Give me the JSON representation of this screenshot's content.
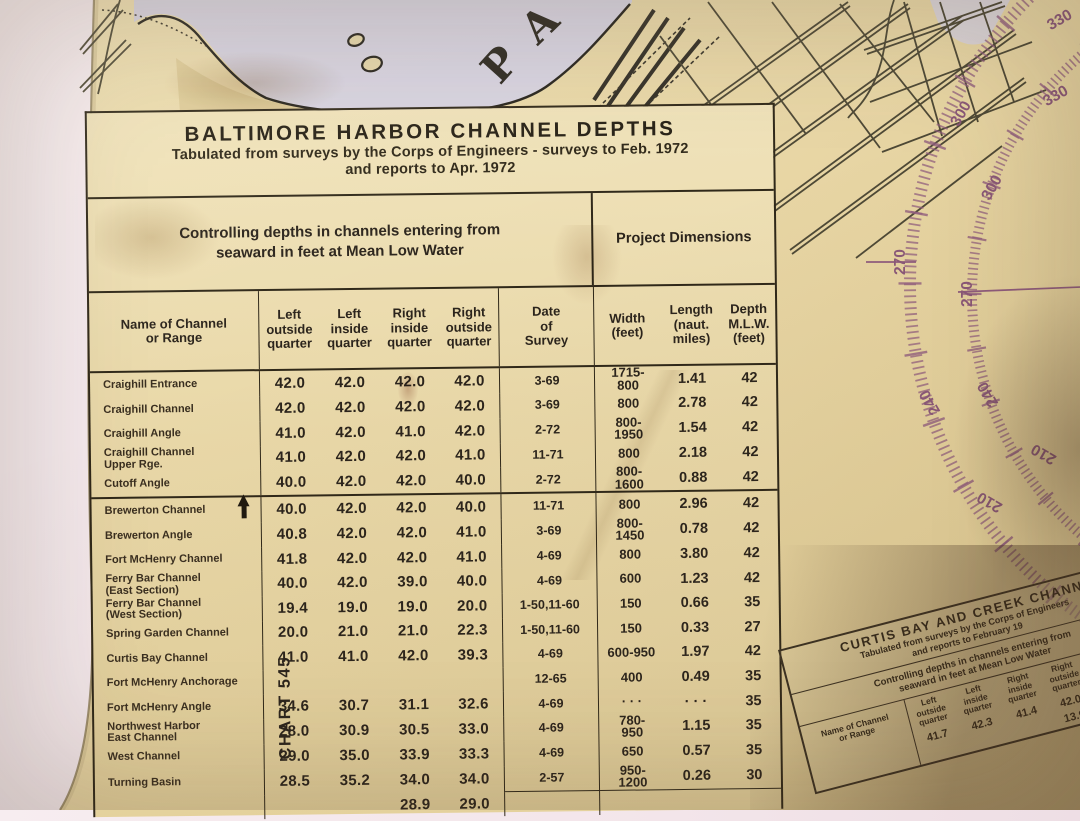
{
  "main_table": {
    "title": "BALTIMORE HARBOR CHANNEL DEPTHS",
    "subtitle1": "Tabulated from surveys by the Corps of Engineers - surveys to Feb. 1972",
    "subtitle2": "and reports to Apr. 1972",
    "group_header_left": "Controlling depths in channels entering from\nseaward in feet at Mean Low Water",
    "group_header_right": "Project Dimensions",
    "columns": {
      "name": "Name of Channel\nor Range",
      "q1": "Left\noutside\nquarter",
      "q2": "Left\ninside\nquarter",
      "q3": "Right\ninside\nquarter",
      "q4": "Right\noutside\nquarter",
      "date": "Date\nof\nSurvey",
      "width": "Width\n(feet)",
      "length": "Length\n(naut.\nmiles)",
      "depth": "Depth\nM.L.W.\n(feet)"
    },
    "chart_label": "CHART 545",
    "rows": [
      {
        "n": "Craighill Entrance",
        "q1": "42.0",
        "q2": "42.0",
        "q3": "42.0",
        "q4": "42.0",
        "date": "3-69",
        "w": "1715-\n800",
        "len": "1.41",
        "dep": "42"
      },
      {
        "n": "Craighill Channel",
        "q1": "42.0",
        "q2": "42.0",
        "q3": "42.0",
        "q4": "42.0",
        "date": "3-69",
        "w": "800",
        "len": "2.78",
        "dep": "42"
      },
      {
        "n": "Craighill Angle",
        "q1": "41.0",
        "q2": "42.0",
        "q3": "41.0",
        "q4": "42.0",
        "date": "2-72",
        "w": "800-\n1950",
        "len": "1.54",
        "dep": "42"
      },
      {
        "n": "Craighill Channel\nUpper Rge.",
        "q1": "41.0",
        "q2": "42.0",
        "q3": "42.0",
        "q4": "41.0",
        "date": "11-71",
        "w": "800",
        "len": "2.18",
        "dep": "42"
      },
      {
        "n": "Cutoff Angle",
        "q1": "40.0",
        "q2": "42.0",
        "q3": "42.0",
        "q4": "40.0",
        "date": "2-72",
        "w": "800-\n1600",
        "len": "0.88",
        "dep": "42"
      },
      {
        "n": "Brewerton Channel",
        "arrow": true,
        "q1": "40.0",
        "q2": "42.0",
        "q3": "42.0",
        "q4": "40.0",
        "date": "11-71",
        "w": "800",
        "len": "2.96",
        "dep": "42"
      },
      {
        "n": "Brewerton Angle",
        "q1": "40.8",
        "q2": "42.0",
        "q3": "42.0",
        "q4": "41.0",
        "date": "3-69",
        "w": "800-\n1450",
        "len": "0.78",
        "dep": "42"
      },
      {
        "n": "Fort McHenry Channel",
        "q1": "41.8",
        "q2": "42.0",
        "q3": "42.0",
        "q4": "41.0",
        "date": "4-69",
        "w": "800",
        "len": "3.80",
        "dep": "42"
      },
      {
        "n": "Ferry Bar Channel\n(East Section)",
        "q1": "40.0",
        "q2": "42.0",
        "q3": "39.0",
        "q4": "40.0",
        "date": "4-69",
        "w": "600",
        "len": "1.23",
        "dep": "42"
      },
      {
        "n": "Ferry Bar Channel\n(West Section)",
        "q1": "19.4",
        "q2": "19.0",
        "q3": "19.0",
        "q4": "20.0",
        "date": "1-50,11-60",
        "w": "150",
        "len": "0.66",
        "dep": "35"
      },
      {
        "n": "Spring Garden Channel",
        "q1": "20.0",
        "q2": "21.0",
        "q3": "21.0",
        "q4": "22.3",
        "date": "1-50,11-60",
        "w": "150",
        "len": "0.33",
        "dep": "27"
      },
      {
        "n": "Curtis Bay Channel",
        "q1": "41.0",
        "q2": "41.0",
        "q3": "42.0",
        "q4": "39.3",
        "date": "4-69",
        "w": "600-950",
        "len": "1.97",
        "dep": "42"
      },
      {
        "n": "Fort McHenry Anchorage",
        "q1": "",
        "q2": "",
        "q3": "",
        "q4": "",
        "date": "12-65",
        "w": "400",
        "len": "0.49",
        "dep": "35"
      },
      {
        "n": "Fort McHenry Angle",
        "q1": "34.6",
        "q2": "30.7",
        "q3": "31.1",
        "q4": "32.6",
        "date": "4-69",
        "w": "· · ·",
        "len": "· · ·",
        "dep": "35"
      },
      {
        "n": "Northwest Harbor\nEast Channel",
        "q1": "28.0",
        "q2": "30.9",
        "q3": "30.5",
        "q4": "33.0",
        "date": "4-69",
        "w": "780-\n950",
        "len": "1.15",
        "dep": "35"
      },
      {
        "n": "West Channel",
        "q1": "29.0",
        "q2": "35.0",
        "q3": "33.9",
        "q4": "33.3",
        "date": "4-69",
        "w": "650",
        "len": "0.57",
        "dep": "35"
      },
      {
        "n": "Turning Basin",
        "q1": "28.5",
        "q2": "35.2",
        "q3": "34.0",
        "q4": "34.0",
        "date": "2-57",
        "w": "950-\n1200",
        "len": "0.26",
        "dep": "30"
      },
      {
        "n": "",
        "q1": "",
        "q2": "",
        "q3": "28.9",
        "q4": "29.0",
        "date": "",
        "w": "",
        "len": "",
        "dep": ""
      }
    ]
  },
  "curtis_table": {
    "title": "CURTIS BAY AND CREEK CHANN",
    "subtitle1": "Tabulated from surveys by the Corps of Engineers",
    "subtitle2": "and reports to February 19",
    "header_left": "Controlling depths in channels entering from\nseaward in feet at Mean Low Water",
    "col_name": "Name of Channel\nor Range",
    "col_q1": "Left\noutside\nquarter",
    "col_q2": "Left\ninside\nquarter",
    "col_q3": "Right\ninside\nquarter",
    "col_q4": "Right\noutside\nquarter",
    "col_date": "Date\nof\nSurvey",
    "row1": {
      "q1": "41.7",
      "q2": "42.3",
      "q3": "41.4",
      "q4": "42.0",
      "date": "4-69"
    },
    "row2": {
      "q4": "13.9",
      "date": "7-69,1-60"
    }
  },
  "compass": {
    "outer_labels": [
      "330",
      "300",
      "270",
      "240",
      "210"
    ],
    "inner_labels": [
      "330",
      "300",
      "270",
      "240",
      "210"
    ],
    "color": "#8f5c7d"
  },
  "map": {
    "river_letters": [
      "P",
      "A"
    ]
  },
  "colors": {
    "paper": "#e8d7a6",
    "wall": "#f3e5ea",
    "water": "#d7d3e1",
    "ink": "#2b241c",
    "compass_purple": "#8f5c7d"
  }
}
